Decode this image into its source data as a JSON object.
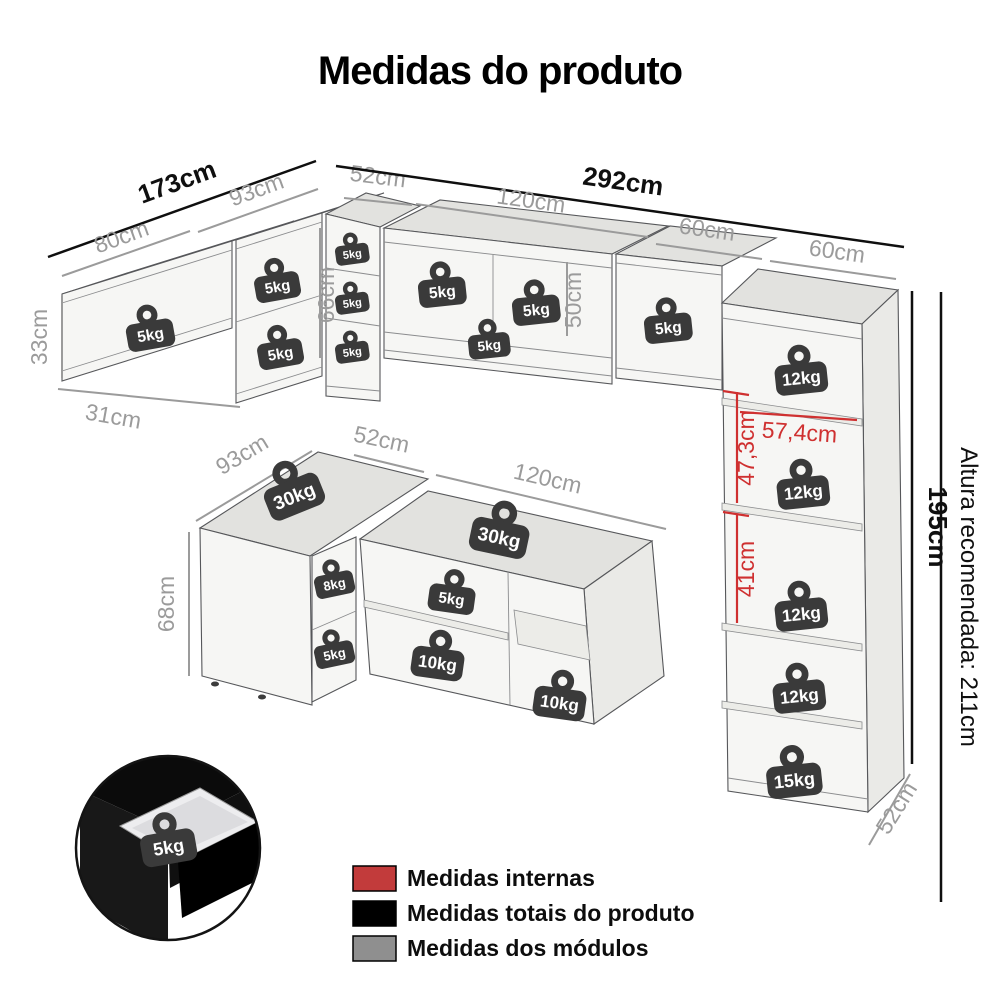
{
  "title": "Medidas do produto",
  "upper_assembly": {
    "total_width_left": "173cm",
    "total_width_right": "292cm",
    "left_module_width": "80cm",
    "corner_module_width": "93cm",
    "corner_module_depth": "52cm",
    "center_module_width": "120cm",
    "right_module_width": "60cm",
    "tall_top_module_width": "60cm",
    "left_module_height": "33cm",
    "left_module_depth": "31cm",
    "corner_module_height": "66cm",
    "center_module_height": "50cm",
    "weights": [
      "5kg",
      "5kg",
      "5kg",
      "5kg",
      "5kg",
      "5kg",
      "5kg",
      "5kg",
      "5kg",
      "5kg"
    ]
  },
  "tall_cabinet": {
    "height": "195cm",
    "depth": "52cm",
    "internal_width": "57,4cm",
    "internal_height_upper": "47,3cm",
    "internal_height_lower": "41cm",
    "recommended_height_note": "Altura recomendada: 211cm",
    "weights": [
      "12kg",
      "12kg",
      "12kg",
      "12kg",
      "15kg"
    ]
  },
  "lower_assembly": {
    "corner_module_width": "93cm",
    "corner_module_depth": "52cm",
    "center_module_width": "120cm",
    "module_height": "68cm",
    "weights": [
      "30kg",
      "8kg",
      "5kg",
      "30kg",
      "5kg",
      "10kg",
      "10kg"
    ]
  },
  "drawer_detail": {
    "weight": "5kg"
  },
  "legend": {
    "items": [
      {
        "label": "Medidas internas",
        "color": "#c23b3b"
      },
      {
        "label": "Medidas totais do produto",
        "color": "#000000"
      },
      {
        "label": "Medidas dos módulos",
        "color": "#8f8f8f"
      }
    ]
  }
}
